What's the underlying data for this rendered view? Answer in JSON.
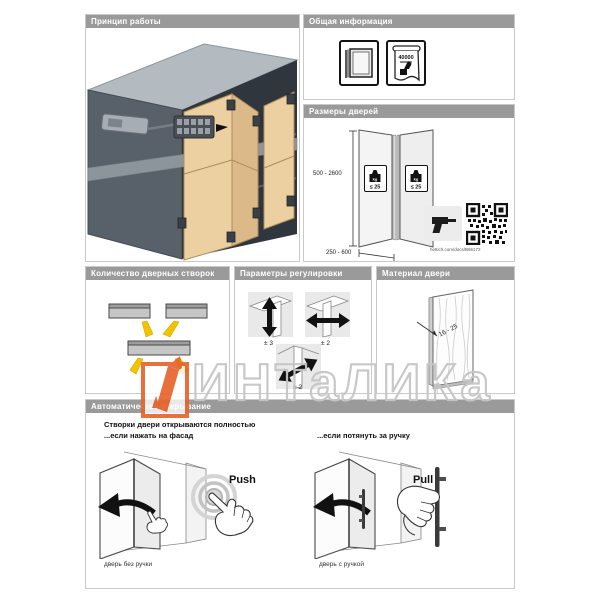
{
  "watermark": {
    "text": "ИНТаЛИКа"
  },
  "colors": {
    "accent_orange": "#e8632c",
    "arrow_yellow": "#f3c300",
    "wood": "#ecd0a2",
    "header_gray": "#9a9a9a"
  },
  "panels": {
    "principle": {
      "title": "Принцип работы"
    },
    "general_info": {
      "title": "Общая информация",
      "durability_value": "40000"
    },
    "door_sizes": {
      "title": "Размеры дверей",
      "height_range": "500 - 2600",
      "width_range": "250 - 600",
      "weight_unit": "kg",
      "weight_limit": "≤ 25",
      "doc_link": "hettich.com/docs/B66172"
    },
    "leaf_count": {
      "title": "Количество дверных створок"
    },
    "adjustment": {
      "title": "Параметры регулировки",
      "vertical_label": "± 3",
      "side_label": "± 2",
      "depth_label": "± 2"
    },
    "material": {
      "title": "Материал двери",
      "thickness_range": "16 - 25"
    },
    "auto_open": {
      "title": "Автоматическое открывание",
      "statement_line1": "Створки двери открываются полностью",
      "statement_line2": "...если нажать на фасад",
      "statement_right": "...если потянуть за ручку",
      "push_label": "Push",
      "pull_label": "Pull",
      "caption_no_handle": "дверь без ручки",
      "caption_with_handle": "дверь с ручкой"
    }
  }
}
